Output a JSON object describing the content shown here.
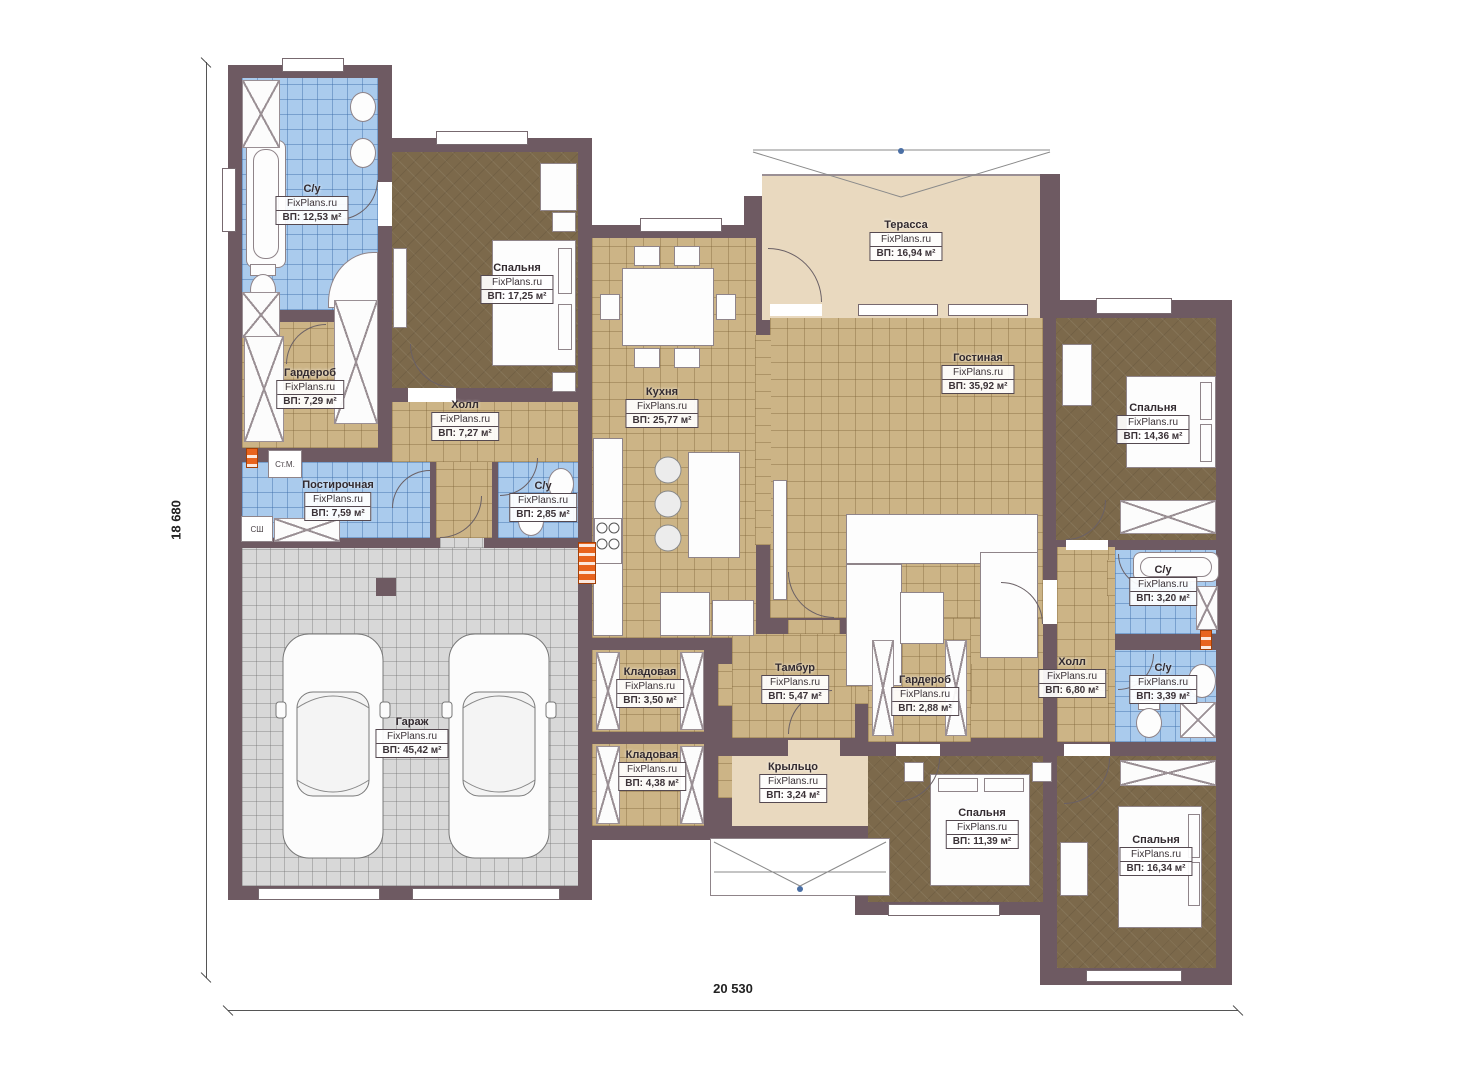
{
  "brand": "FixPlans.ru",
  "dimensions": {
    "height_label": "18 680",
    "width_label": "20 530"
  },
  "appliance_labels": {
    "washing_machine": "Ст.М.",
    "dryer": "СШ"
  },
  "rooms": [
    {
      "id": "bathroom-1",
      "name": "С/у",
      "area": "ВП: 12,53 м²"
    },
    {
      "id": "bedroom-1",
      "name": "Спальня",
      "area": "ВП: 17,25 м²"
    },
    {
      "id": "wardrobe-1",
      "name": "Гардероб",
      "area": "ВП: 7,29 м²"
    },
    {
      "id": "hall-1",
      "name": "Холл",
      "area": "ВП: 7,27 м²"
    },
    {
      "id": "laundry",
      "name": "Постирочная",
      "area": "ВП: 7,59 м²"
    },
    {
      "id": "bathroom-2",
      "name": "С/у",
      "area": "ВП: 2,85 м²"
    },
    {
      "id": "kitchen",
      "name": "Кухня",
      "area": "ВП: 25,77 м²"
    },
    {
      "id": "terrace",
      "name": "Терасса",
      "area": "ВП: 16,94 м²"
    },
    {
      "id": "living-room",
      "name": "Гостиная",
      "area": "ВП: 35,92 м²"
    },
    {
      "id": "bedroom-2",
      "name": "Спальня",
      "area": "ВП: 14,36 м²"
    },
    {
      "id": "bathroom-3",
      "name": "С/у",
      "area": "ВП: 3,20 м²"
    },
    {
      "id": "hall-2",
      "name": "Холл",
      "area": "ВП: 6,80 м²"
    },
    {
      "id": "bathroom-4",
      "name": "С/у",
      "area": "ВП: 3,39 м²"
    },
    {
      "id": "wardrobe-2",
      "name": "Гардероб",
      "area": "ВП: 2,88 м²"
    },
    {
      "id": "vestibule",
      "name": "Тамбур",
      "area": "ВП: 5,47 м²"
    },
    {
      "id": "storage-1",
      "name": "Кладовая",
      "area": "ВП: 3,50 м²"
    },
    {
      "id": "storage-2",
      "name": "Кладовая",
      "area": "ВП: 4,38 м²"
    },
    {
      "id": "garage",
      "name": "Гараж",
      "area": "ВП: 45,42 м²"
    },
    {
      "id": "porch",
      "name": "Крыльцо",
      "area": "ВП: 3,24 м²"
    },
    {
      "id": "bedroom-3",
      "name": "Спальня",
      "area": "ВП: 11,39 м²"
    },
    {
      "id": "bedroom-4",
      "name": "Спальня",
      "area": "ВП: 16,34 м²"
    }
  ]
}
